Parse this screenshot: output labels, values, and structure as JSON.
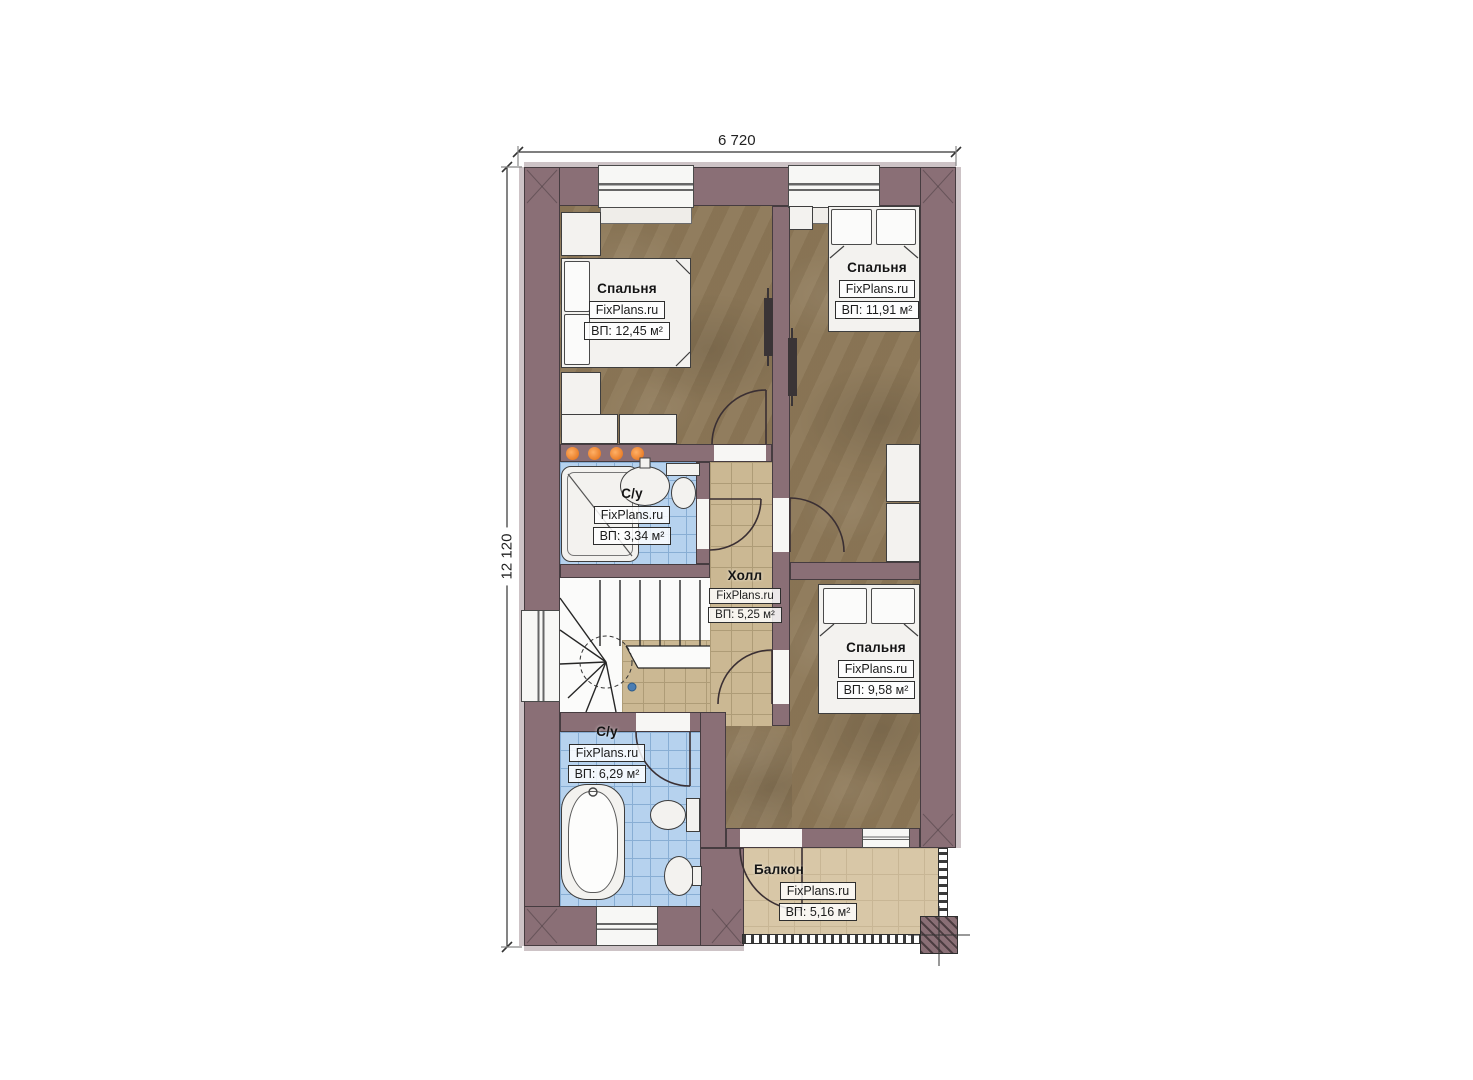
{
  "dimensions": {
    "top": "6 720",
    "left": "12 120"
  },
  "rooms": {
    "bedroom_top_left": {
      "name": "Спальня",
      "watermark": "FixPlans.ru",
      "area": "ВП: 12,45 м²"
    },
    "bedroom_top_right": {
      "name": "Спальня",
      "watermark": "FixPlans.ru",
      "area": "ВП: 11,91 м²"
    },
    "bathroom_small": {
      "name": "С/у",
      "watermark": "FixPlans.ru",
      "area": "ВП: 3,34 м²"
    },
    "hall": {
      "name": "Холл",
      "watermark": "FixPlans.ru",
      "area": "ВП: 5,25 м²"
    },
    "bedroom_bottom": {
      "name": "Спальня",
      "watermark": "FixPlans.ru",
      "area": "ВП: 9,58 м²"
    },
    "bathroom_large": {
      "name": "С/у",
      "watermark": "FixPlans.ru",
      "area": "ВП: 6,29 м²"
    },
    "balcony": {
      "name": "Балкон",
      "watermark": "FixPlans.ru",
      "area": "ВП: 5,16 м²"
    }
  },
  "colors": {
    "wall": "#8a6f76",
    "bedroom_floor": "#8d7857",
    "hall_floor": "#cbb893",
    "bathroom_floor": "#b6d2ee",
    "balcony_floor": "#d8c7a7",
    "accent_dots": "#ea7c24"
  }
}
